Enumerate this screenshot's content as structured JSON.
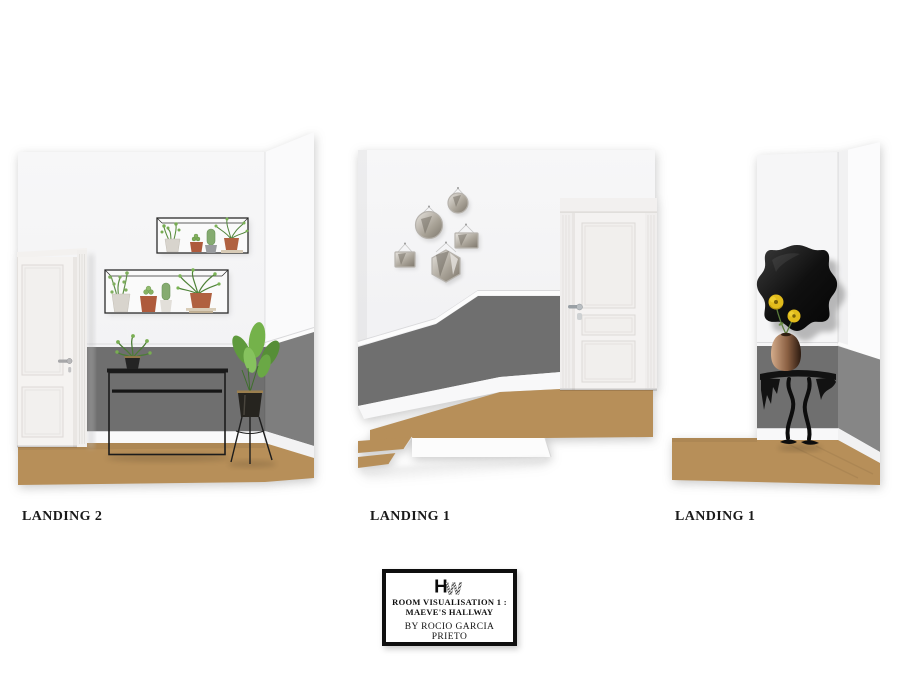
{
  "board": {
    "background": "#ffffff"
  },
  "views": [
    {
      "label": "LANDING 2"
    },
    {
      "label": "LANDING 1"
    },
    {
      "label": "LANDING 1"
    }
  ],
  "title_block": {
    "monogram": {
      "letter_h": "H",
      "letter_w": "W"
    },
    "line1": "ROOM VISUALISATION 1 :",
    "line2": "MAEVE'S HALLWAY",
    "byline": "BY ROCIO GARCIA PRIETO"
  },
  "colors": {
    "wall_white": "#f6f6f7",
    "wainscot_gray": "#6f6f6f",
    "wainscot_gray_side": "#7e7e7e",
    "floor_tan": "#b78f59",
    "baseboard_white": "#f9f9fa",
    "door_white": "#f4f2f0",
    "accent_black": "#111111",
    "plant_green": "#6fa14b",
    "terracotta": "#ae5a3c",
    "flower_yellow": "#e2bc1c"
  }
}
